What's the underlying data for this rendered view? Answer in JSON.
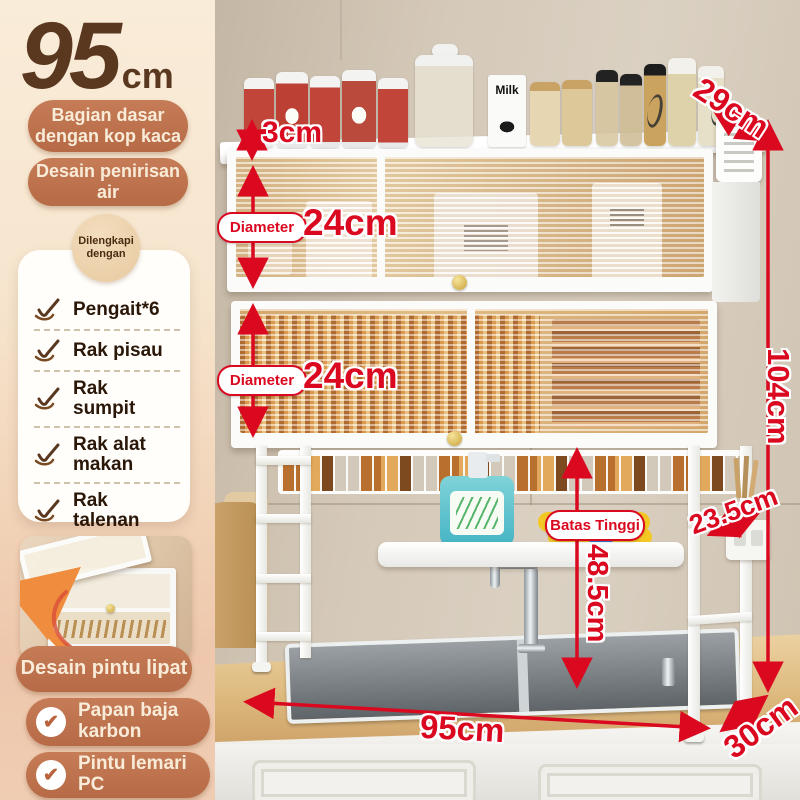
{
  "headline": {
    "value": "95",
    "unit": "cm"
  },
  "left_panel": {
    "badge_base": "Bagian dasar dengan kop kaca",
    "badge_drain": "Desain penirisan air",
    "card_title": "Dilengkapi dengan",
    "items": [
      {
        "label": "Pengait*6"
      },
      {
        "label": "Rak pisau"
      },
      {
        "label": "Rak sumpit"
      },
      {
        "label": "Rak alat makan"
      },
      {
        "label": "Rak talenan"
      }
    ],
    "inset_badge": "Desain pintu lipat",
    "badge_steel": "Papan baja karbon",
    "badge_door": "Pintu lemari PC"
  },
  "annotations": {
    "top_clearance": "3cm",
    "diameter_label": "Diameter",
    "diameter_top": "24cm",
    "diameter_bottom": "24cm",
    "top_depth": "29cm",
    "total_height": "104cm",
    "side_depth": "23.5cm",
    "limit_label": "Batas Tinggi",
    "clearance_height": "48.5cm",
    "width": "95cm",
    "base_depth": "30cm"
  },
  "scene": {
    "milk_carton": "Milk"
  },
  "icons": {
    "check": "✔"
  },
  "colors": {
    "accent_red": "#da0920",
    "badge_terracotta": "#bf7250",
    "headline_brown": "#5a3820"
  }
}
